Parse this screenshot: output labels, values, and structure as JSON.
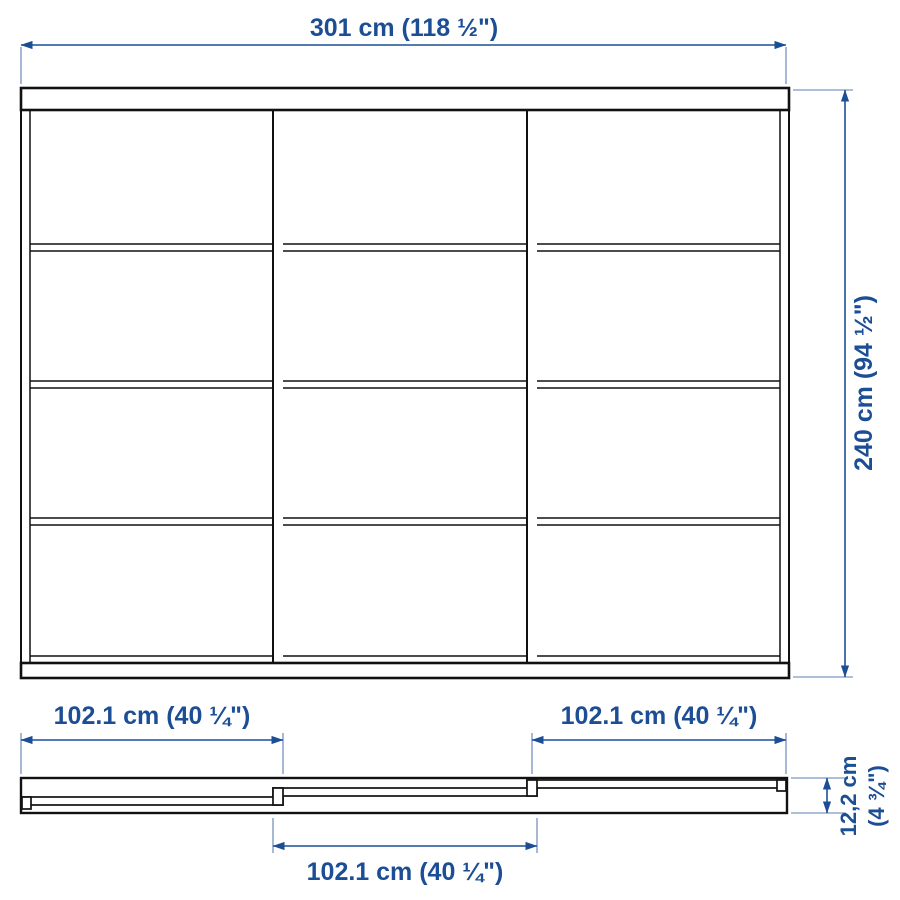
{
  "diagram": {
    "labels": {
      "total_width": "301 cm (118 ½\")",
      "total_height": "240 cm (94 ½\")",
      "door_left_width": "102.1 cm (40 ¼\")",
      "door_center_width": "102.1 cm (40 ¼\")",
      "door_right_width": "102.1 cm (40 ¼\")",
      "depth_line1": "12,2 cm",
      "depth_line2": "(4 ¾\")"
    },
    "structure": {
      "doors": 3,
      "panes_per_door": 4
    },
    "colors": {
      "dimension_blue": "#1C4E96",
      "extension_blue": "#5C7FB5",
      "line_black": "#111111",
      "background": "#FFFFFF"
    }
  }
}
